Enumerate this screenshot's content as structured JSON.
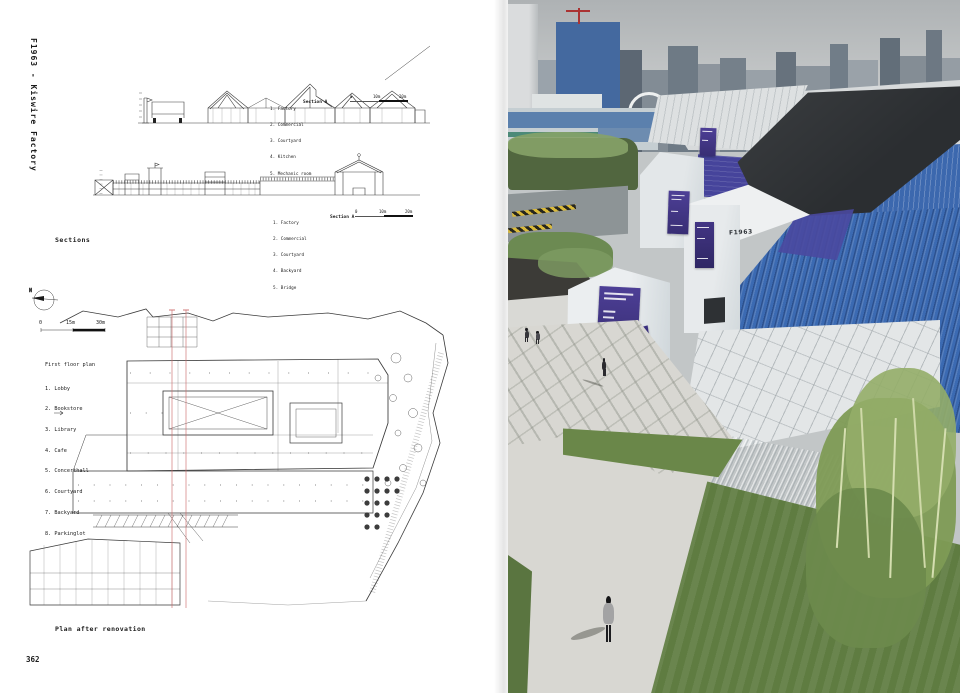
{
  "book": {
    "spine_title": "F1963 - Kiswire Factory",
    "page_number": "362",
    "sections_caption": "Sections",
    "plan_caption": "Plan after renovation"
  },
  "sections": {
    "a": {
      "label": "Section A",
      "legend": [
        "1. Factory",
        "2. Commercial",
        "3. Courtyard",
        "4. Kitchen",
        "5. Mechanic room"
      ],
      "scale": [
        "0",
        "10m",
        "20m"
      ]
    },
    "b": {
      "label": "Section A",
      "legend": [
        "1. Factory",
        "2. Commercial",
        "3. Courtyard",
        "4. Backyard",
        "5. Bridge"
      ],
      "scale": [
        "0",
        "10m",
        "20m"
      ]
    }
  },
  "floor_plan": {
    "title": "First floor plan",
    "legend": [
      "1. Lobby",
      "2. Bookstore",
      "3. Library",
      "4. Cafe",
      "5. Concerthall",
      "6. Courtyard",
      "7. Backyard",
      "8. Parkinglot"
    ],
    "scale": [
      "0",
      "15m",
      "30m"
    ],
    "north": "N"
  },
  "photo": {
    "wall_sign": "F1963",
    "colors": {
      "banner_purple": "#473a8e",
      "roof_blue": "#3f72b8",
      "roof_indigo": "#46449b",
      "roof_black": "#2b2e31",
      "grass_green": "#66813f"
    }
  }
}
